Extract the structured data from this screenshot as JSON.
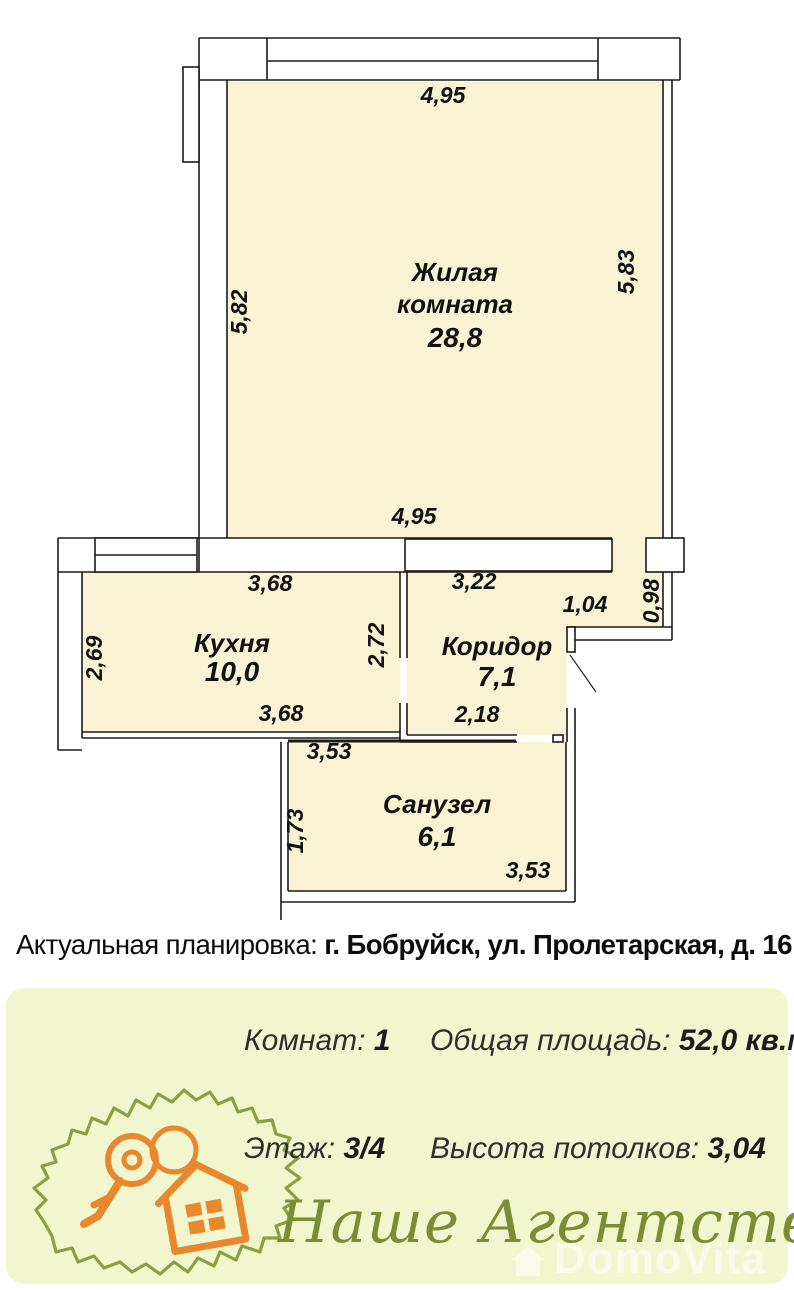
{
  "plan": {
    "dimension_labels": [
      {
        "t": "4,95",
        "x": 443,
        "y": 103,
        "r": 0
      },
      {
        "t": "5,82",
        "x": 247,
        "y": 312,
        "r": -90
      },
      {
        "t": "5,83",
        "x": 634,
        "y": 272,
        "r": -90
      },
      {
        "t": "4,95",
        "x": 414,
        "y": 524,
        "r": 0
      },
      {
        "t": "3,68",
        "x": 270,
        "y": 591,
        "r": 0
      },
      {
        "t": "3,22",
        "x": 474,
        "y": 589,
        "r": 0
      },
      {
        "t": "1,04",
        "x": 585,
        "y": 612,
        "r": 0
      },
      {
        "t": "0,98",
        "x": 659,
        "y": 601,
        "r": -90
      },
      {
        "t": "2,72",
        "x": 384,
        "y": 645,
        "r": -90
      },
      {
        "t": "2,69",
        "x": 102,
        "y": 658,
        "r": -90
      },
      {
        "t": "3,68",
        "x": 281,
        "y": 721,
        "r": 0
      },
      {
        "t": "2,18",
        "x": 477,
        "y": 722,
        "r": 0
      },
      {
        "t": "3,53",
        "x": 329,
        "y": 759,
        "r": 0
      },
      {
        "t": "1,73",
        "x": 303,
        "y": 831,
        "r": -90
      },
      {
        "t": "3,53",
        "x": 528,
        "y": 878,
        "r": 0
      }
    ],
    "rooms": [
      {
        "name_lines": [
          "Жилая",
          "комната"
        ],
        "area": "28,8",
        "cx": 455,
        "name_y": [
          281,
          313
        ],
        "area_y": 347
      },
      {
        "name_lines": [
          "Кухня"
        ],
        "area": "10,0",
        "cx": 232,
        "name_y": [
          652
        ],
        "area_y": 681
      },
      {
        "name_lines": [
          "Коридор"
        ],
        "area": "7,1",
        "cx": 497,
        "name_y": [
          655
        ],
        "area_y": 686
      },
      {
        "name_lines": [
          "Санузел"
        ],
        "area": "6,1",
        "cx": 437,
        "name_y": [
          813
        ],
        "area_y": 846
      }
    ]
  },
  "address": {
    "prefix": "Актуальная планировка: ",
    "bold": "г. Бобруйск, ул. Пролетарская, д. 16"
  },
  "footer": {
    "stats": [
      {
        "label": "Комнат:",
        "value": "1"
      },
      {
        "label": "Общая площадь:",
        "value": "52,0 кв.м."
      },
      {
        "label": "Этаж:",
        "value": "3/4"
      },
      {
        "label": "Высота потолков:",
        "value": "3,04"
      }
    ],
    "agency_name": "Наше Агентство",
    "watermark": "DomoVita"
  },
  "colors": {
    "room_fill": "#faf3d3",
    "wall": "#1b1b1b",
    "footer_bg": "#f2f6cf",
    "olive": "#8aa03e",
    "script_green": "#7a8d33",
    "logo_orange": "#e8872b"
  }
}
